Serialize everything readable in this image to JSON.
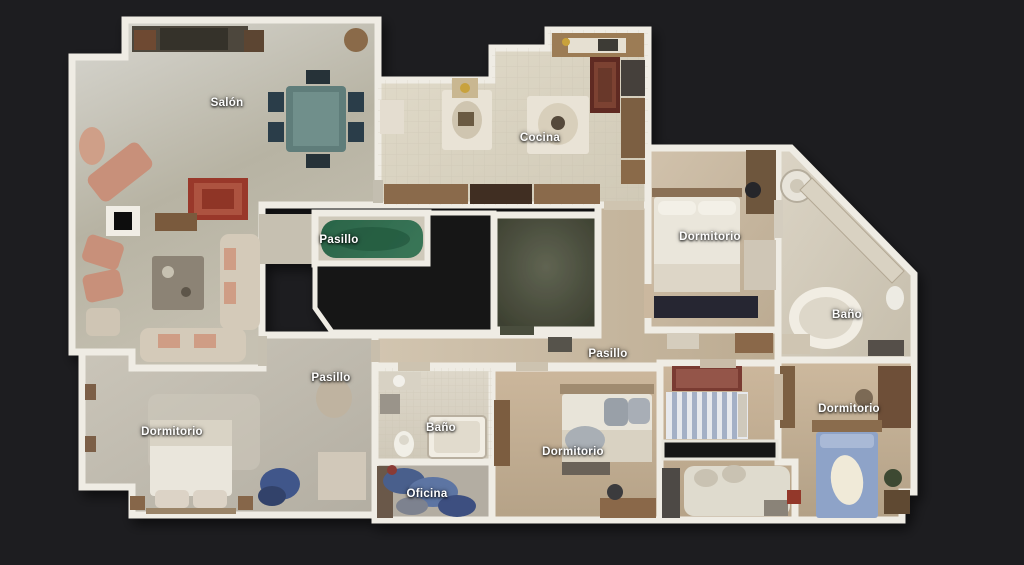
{
  "scene": {
    "type": "3d-dollhouse-floor-plan",
    "view": "top-down",
    "language": "es"
  },
  "palette": {
    "background": "#1d1d20",
    "wall": "#efece4",
    "label_text": "#ffffff",
    "unscanned_black": "#141417",
    "hall_rug_green": "#2d6b4e",
    "salon_rug_red": "#99392b",
    "bed_blue": "#8ea3c8",
    "office_blue": "#5d74a3"
  },
  "rooms": [
    {
      "id": "salon",
      "label": "Salón",
      "x": 227,
      "y": 103
    },
    {
      "id": "cocina",
      "label": "Cocina",
      "x": 540,
      "y": 138
    },
    {
      "id": "pasillo-top",
      "label": "Pasillo",
      "x": 339,
      "y": 240
    },
    {
      "id": "dormitorio-top-right",
      "label": "Dormitorio",
      "x": 710,
      "y": 237
    },
    {
      "id": "bano-right",
      "label": "Baño",
      "x": 847,
      "y": 315
    },
    {
      "id": "pasillo-center",
      "label": "Pasillo",
      "x": 608,
      "y": 354
    },
    {
      "id": "pasillo-left",
      "label": "Pasillo",
      "x": 331,
      "y": 378
    },
    {
      "id": "dormitorio-bottom-left",
      "label": "Dormitorio",
      "x": 172,
      "y": 432
    },
    {
      "id": "bano-bottom",
      "label": "Baño",
      "x": 441,
      "y": 428
    },
    {
      "id": "oficina",
      "label": "Oficina",
      "x": 427,
      "y": 494
    },
    {
      "id": "dormitorio-bottom-center",
      "label": "Dormitorio",
      "x": 573,
      "y": 452
    },
    {
      "id": "dormitorio-bottom-right",
      "label": "Dormitorio",
      "x": 849,
      "y": 409
    }
  ]
}
